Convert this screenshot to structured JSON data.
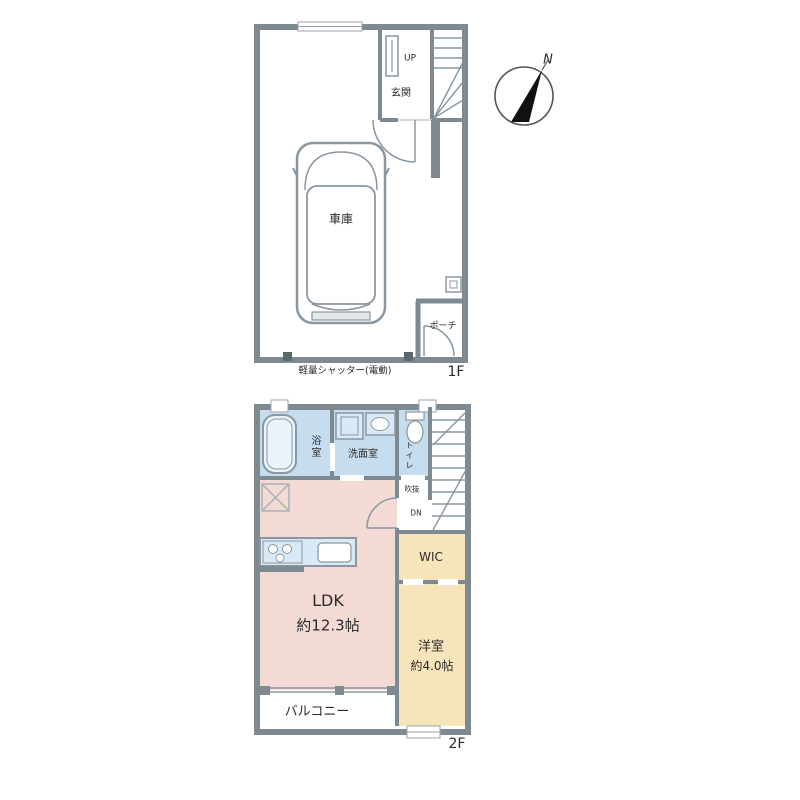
{
  "plan": {
    "floor1": {
      "floor_label": "1F",
      "rooms": {
        "garage": "車庫",
        "entrance": "玄関",
        "porch": "ポーチ"
      },
      "stairs_up_label": "UP",
      "shutter_note": "軽量シャッター(電動)",
      "compass_north": "N"
    },
    "floor2": {
      "floor_label": "2F",
      "rooms": {
        "bath": "浴室",
        "washroom": "洗面室",
        "toilet": "トイレ",
        "stair_void": "吹抜",
        "ldk_name": "LDK",
        "ldk_size": "約12.3帖",
        "wic": "WIC",
        "bedroom_name": "洋室",
        "bedroom_size": "約4.0帖",
        "balcony": "バルコニー"
      },
      "stairs_down_label": "DN"
    },
    "colors": {
      "wall": "#7d8a92",
      "wet_area": "#c5ddef",
      "ldk": "#f3dad5",
      "bedroom": "#f6e4bb",
      "fixture_fill": "#d9e9f6",
      "needle": "#111111"
    }
  }
}
